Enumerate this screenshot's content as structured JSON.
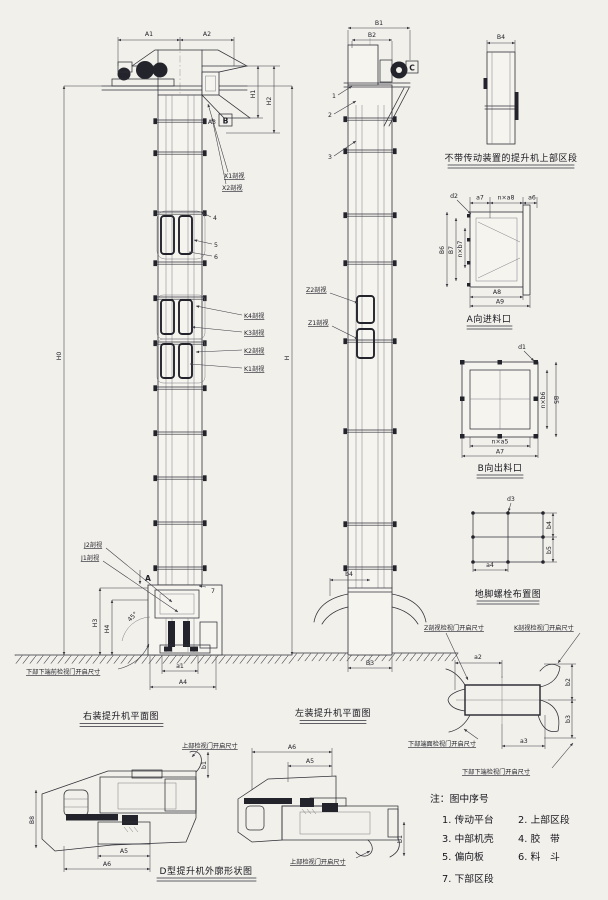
{
  "captions": {
    "right_view": "右装提升机平面图",
    "left_view": "左装提升机平面图",
    "upper_section": "不带传动装置的提升机上部区段",
    "inlet": "A向进料口",
    "outlet": "B向出料口",
    "bolts": "地脚螺栓布置图",
    "outline": "D型提升机外廓形状图"
  },
  "right_view": {
    "dims": {
      "A1": "A1",
      "A2": "A2",
      "A3": "A3",
      "H0": "H0",
      "H": "H",
      "H1": "H1",
      "H2": "H2",
      "H3": "H3",
      "H4": "H4",
      "a1": "a1",
      "A4": "A4",
      "angle": "45°"
    },
    "markers": {
      "A": "A",
      "B": "B"
    },
    "callouts": {
      "X1": "X1剖视",
      "X2": "X2剖视",
      "K4": "K4剖视",
      "K3": "K3剖视",
      "K2": "K2剖视",
      "K1": "K1剖视",
      "J2": "J2剖视",
      "J1": "J1剖视",
      "n4": "4",
      "n5": "5",
      "n6": "6",
      "n7": "7"
    },
    "ground_note": "下部下端前检视门开启尺寸"
  },
  "left_view": {
    "dims": {
      "B1": "B1",
      "B2": "B2",
      "b4": "b4",
      "B3": "B3"
    },
    "markers": {
      "C": "C"
    },
    "callouts": {
      "n1": "1",
      "n2": "2",
      "n3": "3",
      "Z2": "Z2剖视",
      "Z1": "Z1剖视"
    }
  },
  "upper_section": {
    "dims": {
      "B4": "B4"
    }
  },
  "inlet": {
    "dims": {
      "d2": "d2",
      "a7": "a7",
      "na8": "n×a8",
      "a6": "a6",
      "B6": "B6",
      "B7": "B7",
      "nb7": "n×b7",
      "A8": "A8",
      "A9": "A9"
    }
  },
  "outlet": {
    "dims": {
      "d1": "d1",
      "nb6": "n×b6",
      "B5": "B5",
      "na5": "n×a5",
      "A7": "A7"
    }
  },
  "bolts": {
    "dims": {
      "d3": "d3",
      "b4": "b4",
      "b5": "b5",
      "a4": "a4"
    }
  },
  "door_detail": {
    "labels": {
      "z": "Z剖视检视门开启尺寸",
      "k": "K剖视检视门开启尺寸",
      "bl": "下部端面检视门开启尺寸",
      "br": "下部下端检视门开启尺寸"
    },
    "dims": {
      "a2": "a2",
      "b2": "b2",
      "b3": "b3",
      "a3": "a3"
    }
  },
  "outline_views": {
    "door_label": "上部检视门开启尺寸",
    "dims": {
      "B8": "B8",
      "A5": "A5",
      "A6": "A6",
      "b1": "b1"
    }
  },
  "notes": {
    "title": "注：图中序号",
    "items": [
      "1. 传动平台",
      "2. 上部区段",
      "3. 中部机壳",
      "4. 胶　带",
      "5. 偏向板",
      "6. 料　斗",
      "7. 下部区段"
    ]
  }
}
